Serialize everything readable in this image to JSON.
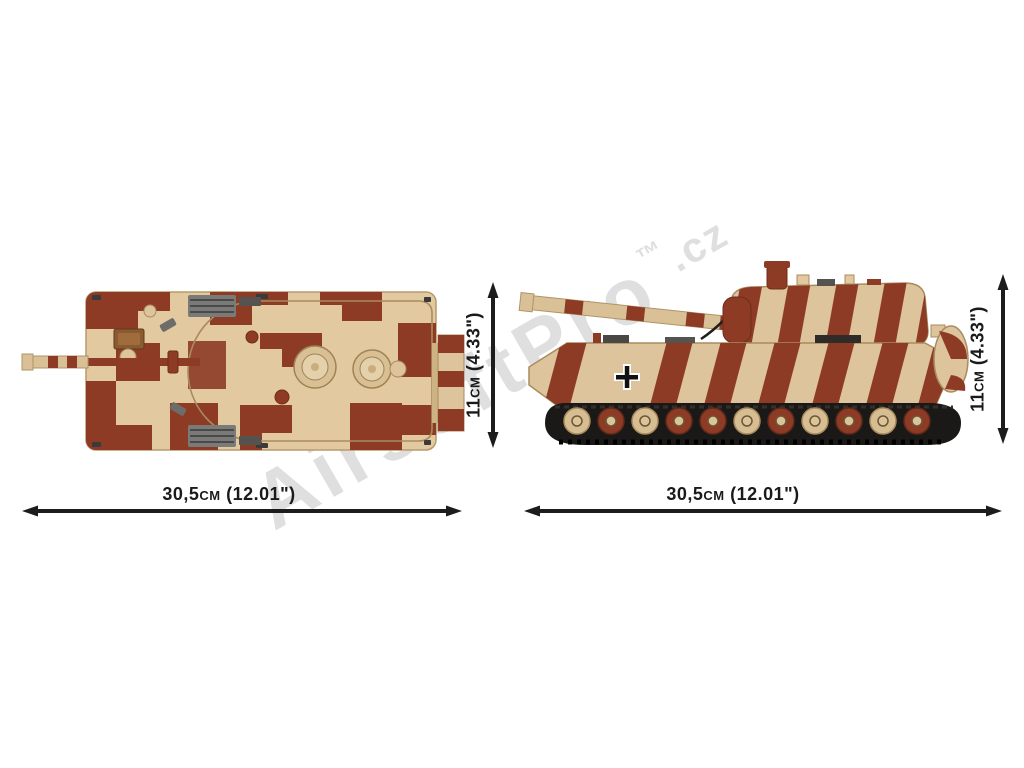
{
  "image": {
    "background": "#ffffff",
    "watermark": {
      "brand": "AirsoftPro",
      "trademark": "™",
      "domain": ".cz"
    },
    "views": {
      "top": {
        "description": "brick-built tank seen from above, red-brown and tan camouflage",
        "width_label": "30,5cm (12.01\")",
        "height_label": "11cm (4.33\")"
      },
      "side": {
        "description": "brick-built tank side profile with striped gun barrel, camo hull and tracked running gear",
        "width_label": "30,5cm (12.01\")",
        "height_label": "11cm (4.33\")"
      }
    },
    "colors": {
      "brick_tan": "#ddc49c",
      "brick_tan_light": "#e6d2ab",
      "camo_red": "#8e3b26",
      "camo_red_dark": "#6f2c1b",
      "track_black": "#1b1917",
      "metal_gray": "#6e6c68",
      "dimension_black": "#1c1c1c",
      "watermark_gray": "#dcdcdc"
    }
  }
}
